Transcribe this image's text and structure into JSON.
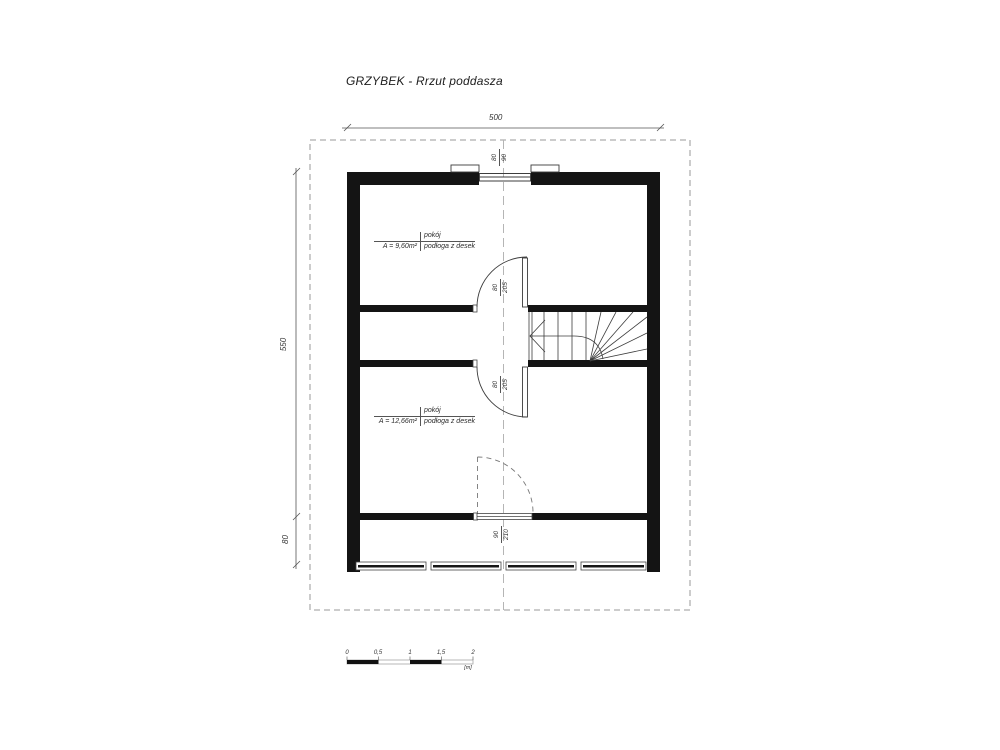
{
  "title": "GRZYBEK - Rrzut poddasza",
  "dimensions": {
    "width_total": "500",
    "height_main": "550",
    "height_bottom": "80",
    "window_top": {
      "width": "80",
      "height": "90"
    },
    "door_upper": {
      "width": "80",
      "height": "205"
    },
    "door_lower": {
      "width": "80",
      "height": "205"
    },
    "door_dashed": {
      "width": "90",
      "height": "210"
    }
  },
  "rooms": [
    {
      "name": "pokój",
      "area": "A = 9,60m²",
      "floor": "podłoga z desek"
    },
    {
      "name": "pokój",
      "area": "A = 12,66m²",
      "floor": "podłoga z desek"
    }
  ],
  "scale_bar": {
    "labels": [
      "0",
      "0,5",
      "1",
      "1,5",
      "2"
    ],
    "unit": "[m]"
  },
  "colors": {
    "wall": "#141414",
    "line": "#3c3c3c",
    "dashed": "#9a9a9a",
    "text": "#2b2b2b"
  }
}
